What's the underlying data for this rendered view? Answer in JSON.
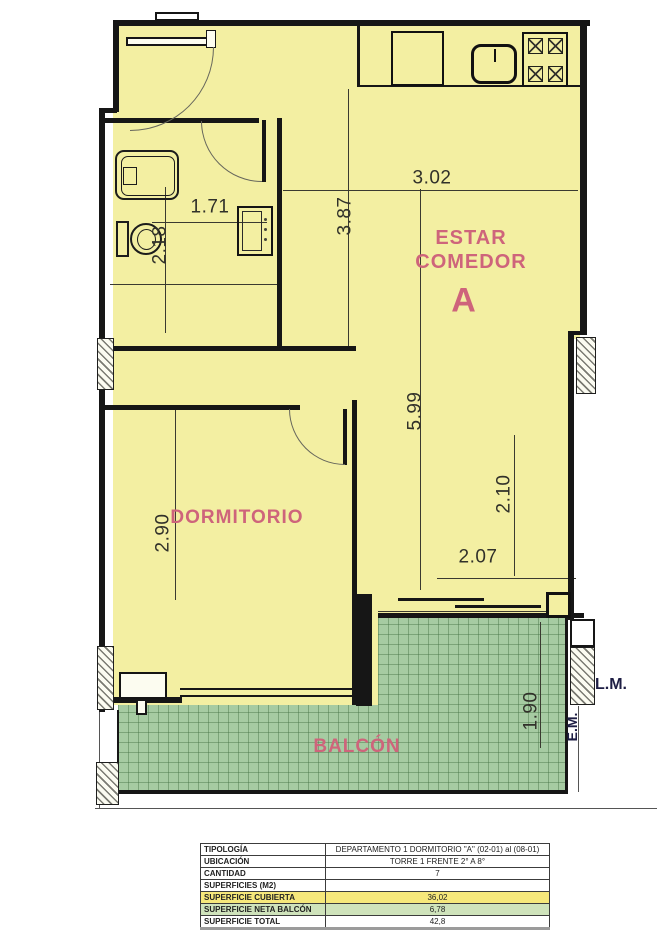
{
  "plan": {
    "room_labels": {
      "living_line1": "ESTAR",
      "living_line2": "COMEDOR",
      "unit": "A",
      "bedroom": "DORMITORIO",
      "balcony": "BALCÓN"
    },
    "dimensions": {
      "bath_width": "1.71",
      "bath_depth": "2.18",
      "living_width": "3.02",
      "living_upper": "3.87",
      "living_length": "5.99",
      "living_lower": "2.10",
      "bedroom_depth": "2.90",
      "balcony_door": "2.07",
      "balcony_depth": "1.90"
    },
    "boundary_labels": {
      "lm": "L.M.",
      "em": "E.M."
    },
    "colors": {
      "interior": "#f3efa2",
      "balcony": "#a6cba2",
      "label_accent": "#ce647b",
      "wall": "#161616",
      "row_highlight_yellow": "#f6e87b",
      "row_highlight_green": "#cfe3bb"
    }
  },
  "table": {
    "rows": [
      {
        "label": "TIPOLOGÍA",
        "value": "DEPARTAMENTO 1 DORMITORIO \"A\" (02-01) al (08-01)"
      },
      {
        "label": "UBICACIÓN",
        "value": "TORRE 1 FRENTE 2° A 8°"
      },
      {
        "label": "CANTIDAD",
        "value": "7"
      },
      {
        "label": "SUPERFICIES (M2)",
        "value": ""
      },
      {
        "label": "SUPERFICIE CUBIERTA",
        "value": "36,02"
      },
      {
        "label": "SUPERFICIE NETA BALCÓN",
        "value": "6,78"
      },
      {
        "label": "SUPERFICIE TOTAL",
        "value": "42,8"
      }
    ]
  }
}
